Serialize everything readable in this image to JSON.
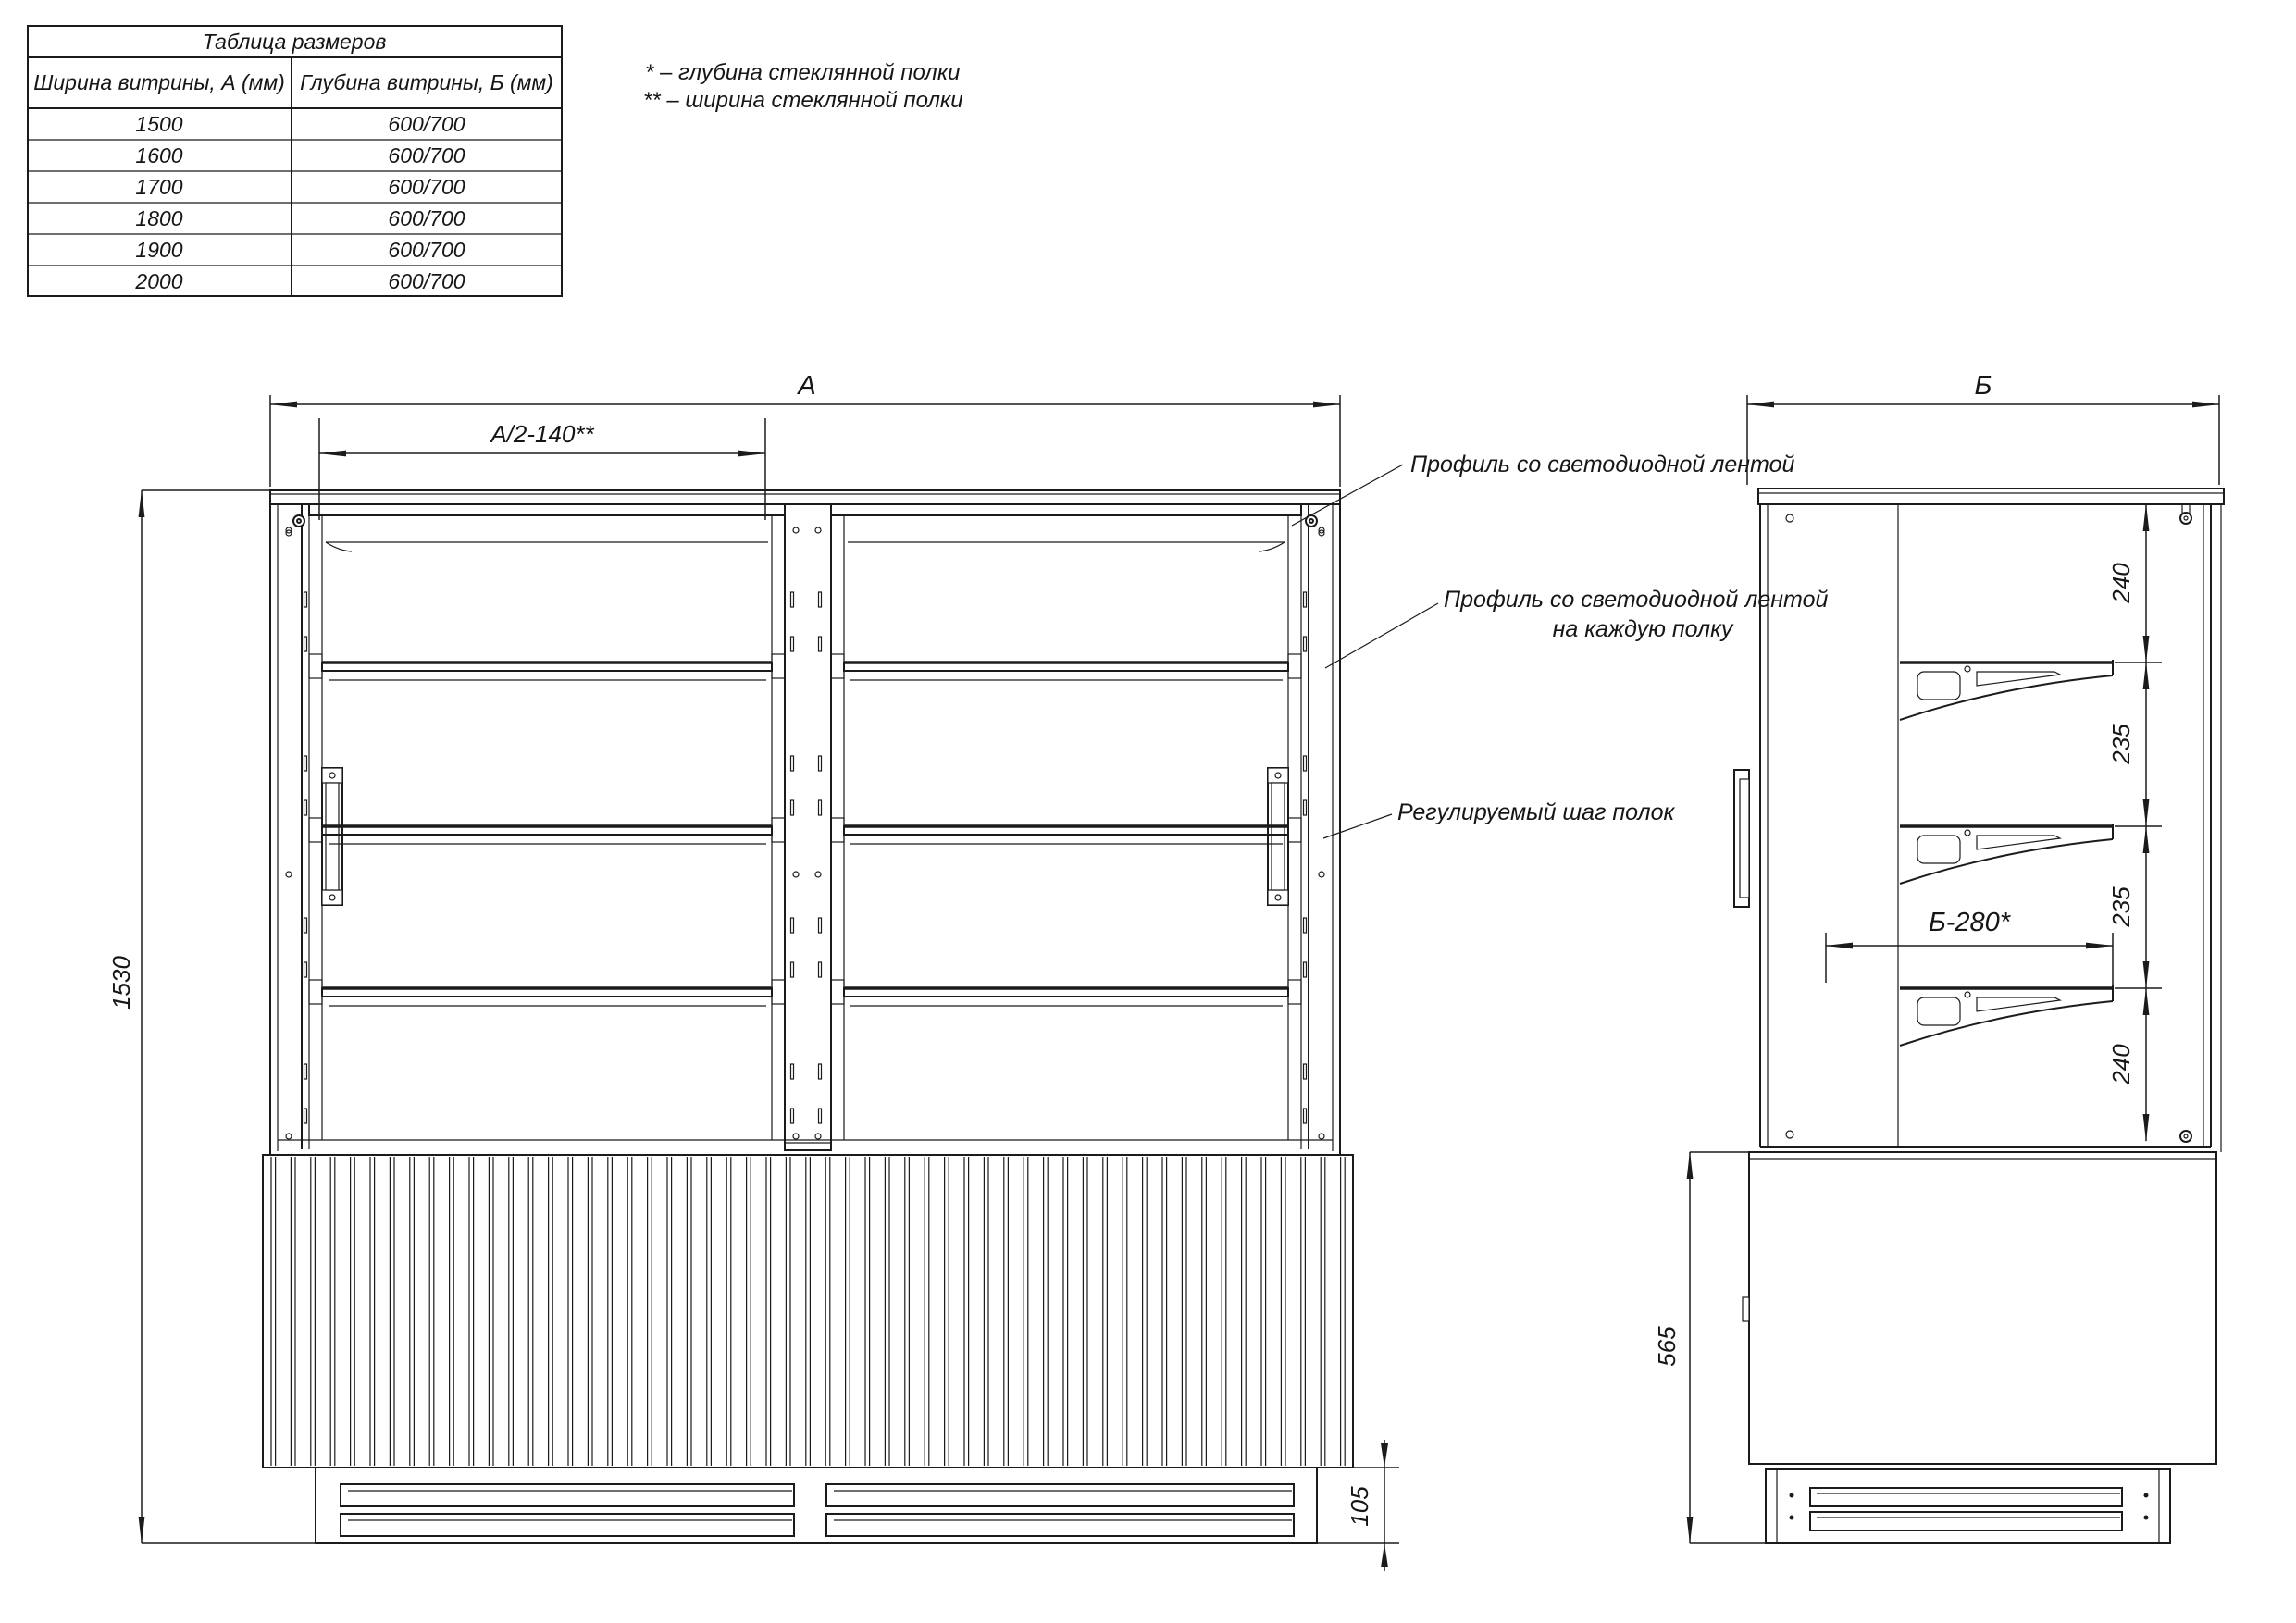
{
  "table": {
    "title": "Таблица размеров",
    "col_width": "Ширина витрины, А (мм)",
    "col_depth": "Глубина витрины, Б (мм)",
    "rows": [
      {
        "width": "1500",
        "depth": "600/700"
      },
      {
        "width": "1600",
        "depth": "600/700"
      },
      {
        "width": "1700",
        "depth": "600/700"
      },
      {
        "width": "1800",
        "depth": "600/700"
      },
      {
        "width": "1900",
        "depth": "600/700"
      },
      {
        "width": "2000",
        "depth": "600/700"
      }
    ]
  },
  "legend": {
    "line1": "* – глубина стеклянной полки",
    "line2": "** – ширина стеклянной полки"
  },
  "front": {
    "dim_width_label": "А",
    "dim_half_label": "А/2-140**",
    "dim_height_label": "1530",
    "dim_plinth_label": "105",
    "callout_top": "Профиль со светодиодной лентой",
    "callout_shelf_line1": "Профиль со светодиодной лентой",
    "callout_shelf_line2": "на каждую полку",
    "callout_step": "Регулируемый шаг полок"
  },
  "side": {
    "dim_depth_label": "Б",
    "seg_240_top": "240",
    "seg_235_a": "235",
    "seg_235_b": "235",
    "seg_240_bottom": "240",
    "dim_shelf_depth": "Б-280*",
    "dim_body_height": "565"
  },
  "colors": {
    "line": "#1b1b1b",
    "background": "#ffffff"
  }
}
